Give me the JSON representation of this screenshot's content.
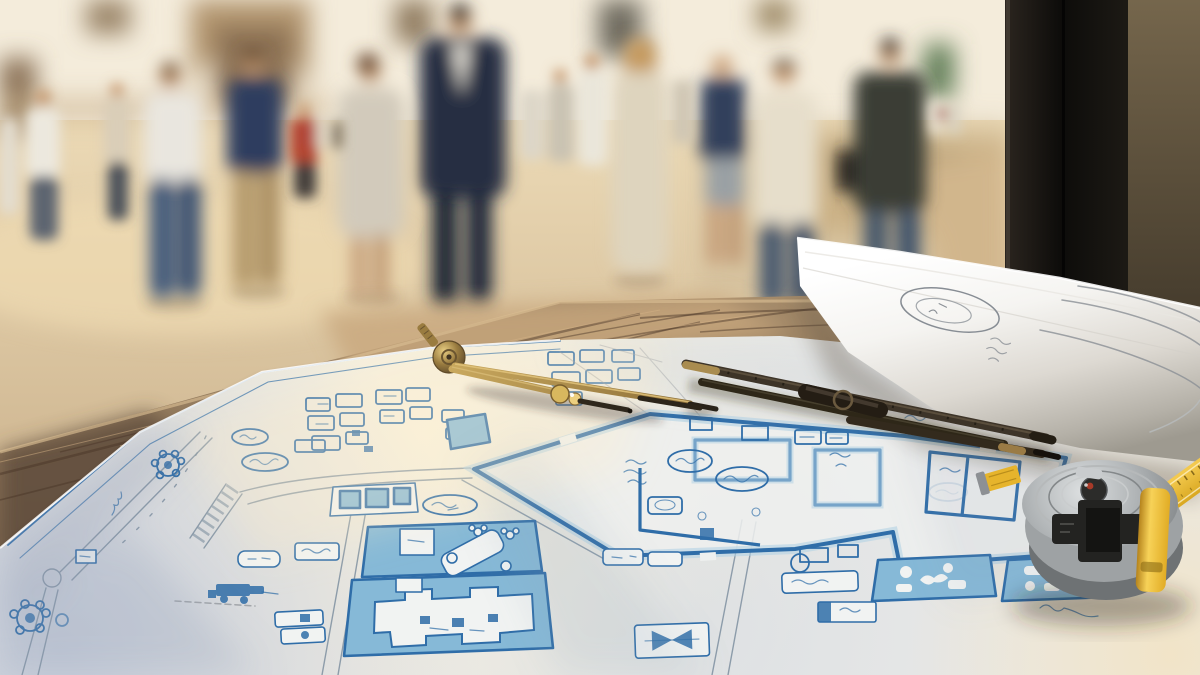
{
  "scene": {
    "description": "Architectural site-plan blueprint spread on a weathered wooden table outdoors at golden hour; a brass drafting compass, dark folding rulers, a rolled-up plan and a chrome tape measure with yellow tape rest on the sheet; blurred pedestrians stroll across a sunlit whitewashed plaza behind",
    "depth_of_field": "background heavily blurred, foreground sheet and tools in focus",
    "time_of_day": "late afternoon golden hour"
  },
  "palette": {
    "ink": "#2f6da8",
    "ink_soft": "#6f9cc4",
    "pool_fill": "#86b9d7",
    "pool_light": "#b3d2e4",
    "road_gray": "#7e8fa0",
    "paper": "#e9e9e7",
    "paper_warm": "#f8f0da",
    "paper_shadow": "#c3cad8",
    "wood_light": "#c8a87d",
    "wood_mid": "#8d7560",
    "wood_dark": "#5f4e3d",
    "pillar_dark": "#16130f",
    "wall_brown": "#6e5f49",
    "brass": "#a98c4f",
    "brass_bright": "#e2c47c",
    "stick_dark": "#342b1f",
    "metal_silver": "#c3c7c8",
    "tape_yellow": "#e8b62c",
    "plaza_warm": "#e6d2ae",
    "building_white": "#f4ecdb",
    "door_green": "#5c7a52"
  },
  "background": {
    "setting": "whitewashed plaza buildings with arched doorway, dark windows, green door, stone wall with railing; dark doorframe pillar and brown wall on the right",
    "pedestrian_count": 16
  },
  "blueprint": {
    "type": "hand-drawn site plan, blue ink on white paper",
    "features": [
      "perimeter road with roundabout gear symbols",
      "hatched crosswalk strip",
      "large walled compound with interior rooms and annotation clouds",
      "blue-filled pool court with rotated white building",
      "large building footprint in blue surround",
      "two blue legend squares with white icons",
      "equipment icon with dashed baseline",
      "bowtie marker box",
      "illegible handwritten annotations"
    ]
  },
  "tools": [
    {
      "name": "brass-drafting-compass"
    },
    {
      "name": "folding-rulers"
    },
    {
      "name": "rolled-blueprint",
      "detail": "faint pencil ellipse logo and scribbles on the roll"
    },
    {
      "name": "tape-measure",
      "detail": "chrome body, dark front label, yellow side clip, yellow tape running off frame"
    }
  ],
  "table": {
    "material": "weathered grey-brown wood planks",
    "detail": "grain streaks and knot visible"
  }
}
